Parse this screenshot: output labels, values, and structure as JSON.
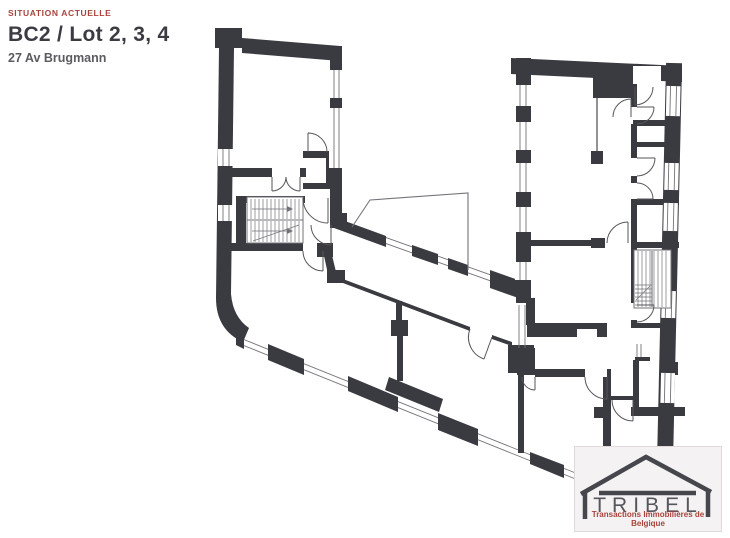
{
  "header": {
    "eyebrow": "SITUATION ACTUELLE",
    "title": "BC2 / Lot 2, 3, 4",
    "subtitle": "27 Av Brugmann"
  },
  "logo": {
    "wordmark": "TRIBEL",
    "tagline": "Transactions Immobilières de Belgique"
  },
  "plan": {
    "kind": "architectural-floor-plan"
  },
  "theme": {
    "canvas_bg": "#ffffff",
    "wall": "#3a3a41",
    "line": "#73737a",
    "door": "#55555b",
    "accent_red": "#a8433b",
    "title_color": "#3b3b43",
    "subtitle_color": "#5b5b62",
    "logo_bg": "#f5f2f3",
    "logo_border": "#e2d8d9",
    "logo_text": "#55555c",
    "logo_house": "#46464d"
  }
}
